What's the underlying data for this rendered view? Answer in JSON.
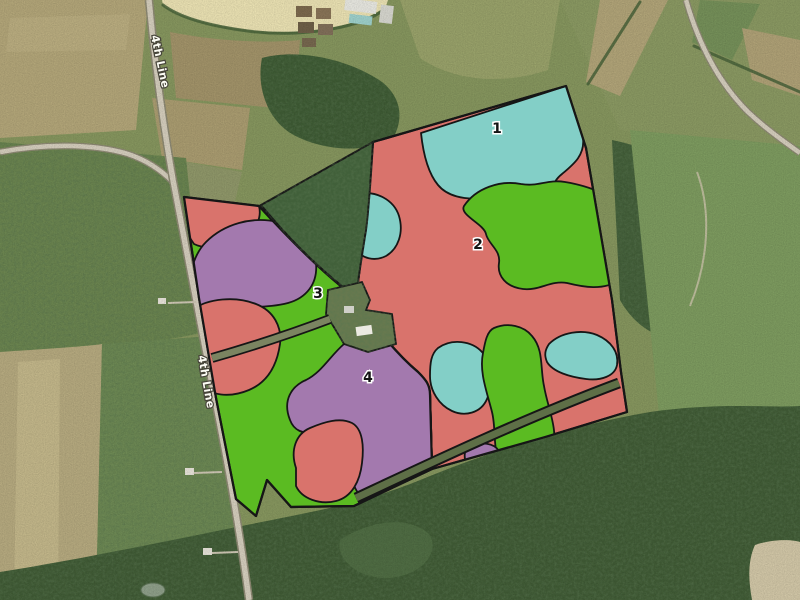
{
  "map": {
    "road_label": "4th Line",
    "zones": [
      {
        "number": "1",
        "color_name": "teal"
      },
      {
        "number": "2",
        "color_name": "red"
      },
      {
        "number": "3",
        "color_name": "green"
      },
      {
        "number": "4",
        "color_name": "purple"
      }
    ],
    "colors": {
      "red": "#d9736c",
      "green": "#5bbb22",
      "purple": "#a379ae",
      "teal": "#83cfc7",
      "outline": "#161616"
    }
  }
}
